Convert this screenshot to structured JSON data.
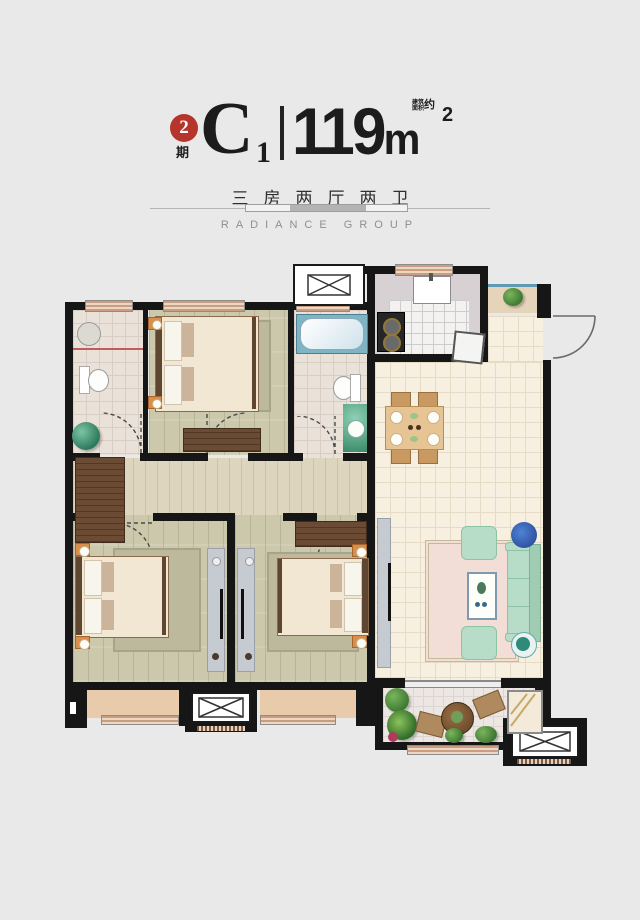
{
  "header": {
    "phase_number": "2",
    "phase_label": "期",
    "unit_letter": "C",
    "unit_number": "1",
    "area_value": "119",
    "area_unit": "m",
    "area_exponent": "2",
    "area_note_line1": "建筑",
    "area_note_line2": "面积",
    "area_note_approx": "约",
    "layout_text": "三房两厅两卫",
    "brand_text": "RADIANCE GROUP"
  },
  "palette": {
    "bg": "#e9e9e9",
    "wall": "#161616",
    "accent": "#b5342b",
    "ink": "#1c1c1c",
    "gray": "#8f8f8f",
    "tilePink": "#eae2d9",
    "tileCream": "#f7f0e0",
    "woodOlive": "#ccc8ac",
    "woodDark": "#6b4b33",
    "winTan": "#eed7c2",
    "winStripe": "#c99d82",
    "mint": "#b7dcc8",
    "carpetPink": "#f3ddd7",
    "orange": "#d98f4a"
  }
}
